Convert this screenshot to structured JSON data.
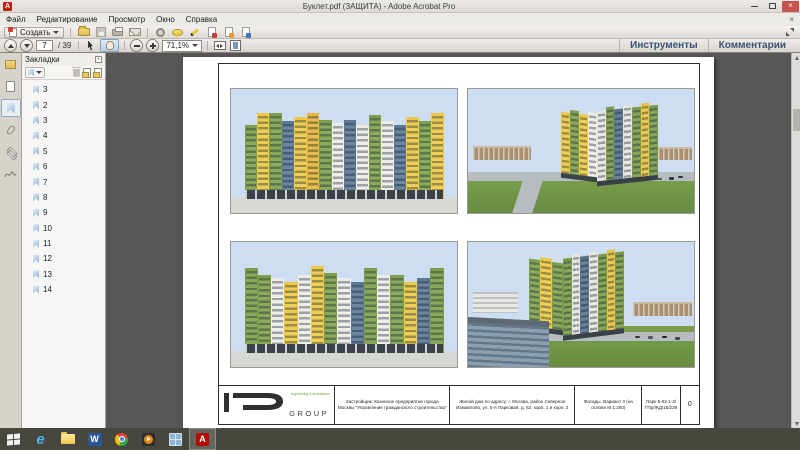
{
  "window": {
    "title": "Буклет.pdf (ЗАЩИТА) - Adobe Acrobat Pro"
  },
  "menu": {
    "items": [
      "Файл",
      "Редактирование",
      "Просмотр",
      "Окно",
      "Справка"
    ]
  },
  "toolbar": {
    "create_label": "Создать",
    "page_current": "7",
    "page_total": "/ 39",
    "zoom_level": "71,1%"
  },
  "actionbar": {
    "tools": "Инструменты",
    "comments": "Комментарии"
  },
  "bookmarks": {
    "title": "Закладки",
    "items": [
      "3",
      "2",
      "3",
      "4",
      "5",
      "6",
      "7",
      "8",
      "9",
      "10",
      "11",
      "12",
      "13",
      "14"
    ]
  },
  "titleblock": {
    "logo_group": "GROUP",
    "logo_tagline": "engineering & architecture",
    "developer": "Застройщик: Казенное предприятие города Москвы \"Управление гражданского строительства\"",
    "address": "Жилой дом по адресу: г. Москва, район Северное Измайлово, ул. 5-я Парковая, д. 62, корп. 1 и корп. 2",
    "sheet": "Фасады. Вариант 3 (на основе М 1:200)",
    "code": "Парк 5-62-1-2/ ГПр/ЖД/15/229",
    "revision": "0"
  },
  "colors": {
    "facade_green": "#7fa04a",
    "facade_yellow": "#ecc843",
    "facade_blue": "#5d7892",
    "sky": "#cedef2",
    "canvas_bg": "#575757",
    "taskbar_bg": "#474740",
    "close_red": "#c75050"
  }
}
